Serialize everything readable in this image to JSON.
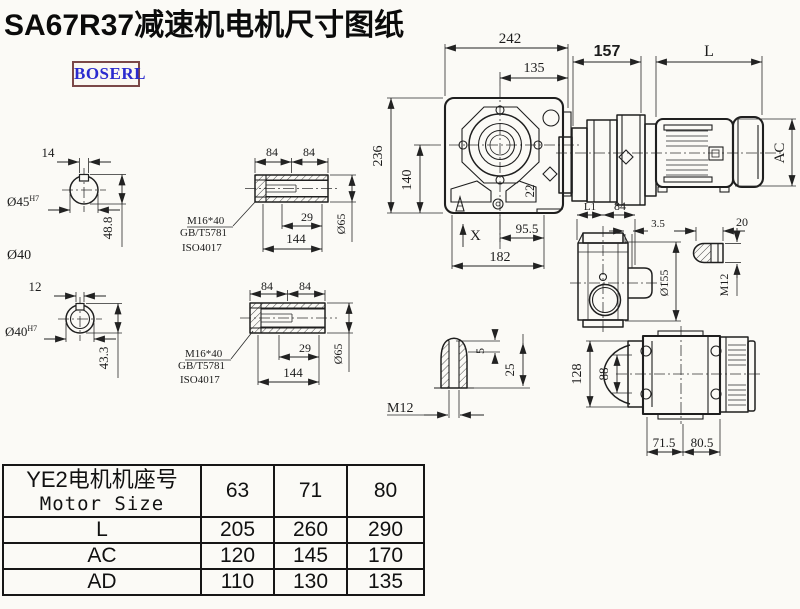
{
  "title": "SA67R37减速机电机尺寸图纸",
  "logo": "BOSERL",
  "colors": {
    "line": "#1f1f1f",
    "logo_text": "#2b2bcf",
    "logo_border": "#7b4848",
    "background": "#fbfaf6"
  },
  "views": {
    "solid_shaft_section": {
      "keyway_width": "14",
      "bore": "Ø45",
      "bore_tol": "H7",
      "keyway_height": "48.8",
      "outer_dia_label": "Ø40"
    },
    "hollow_shaft_section": {
      "keyway_width": "12",
      "bore": "Ø40",
      "bore_tol": "H7",
      "keyway_height": "43.3"
    },
    "hollow_shaft_top": {
      "seg1": "84",
      "seg2": "84",
      "bolt": "M16*40",
      "std1": "GB/T5781",
      "std2": "ISO4017",
      "key_len": "29",
      "total_len": "144",
      "dia": "Ø65"
    },
    "hollow_shaft_bottom": {
      "seg1": "84",
      "seg2": "84",
      "bolt": "M16*40",
      "std1": "GB/T5781",
      "std2": "ISO4017",
      "key_len": "29",
      "total_len": "144",
      "dia": "Ø65"
    },
    "front_view": {
      "width": "242",
      "center_to_face": "135",
      "height": "236",
      "center_height": "140",
      "bolt_size": "22",
      "foot_half": "95.5",
      "foot_width": "182",
      "marker": "X"
    },
    "side_view": {
      "gear_len": "157",
      "motor_len": "L",
      "motor_dia": "AC"
    },
    "output_side_view": {
      "len1": "L1",
      "len2": "84",
      "offset": "3.5",
      "flange_dia": "Ø155"
    },
    "key_section": {
      "width": "20",
      "thread": "M12"
    },
    "shaft_end": {
      "depth": "5",
      "length": "25",
      "thread": "M12"
    },
    "bottom_view": {
      "height": "128",
      "inner_height": "88",
      "len1": "71.5",
      "len2": "80.5"
    }
  },
  "table": {
    "header_line1": "YE2电机机座号",
    "header_line2": "Motor Size",
    "sizes": [
      "63",
      "71",
      "80"
    ],
    "rows": [
      {
        "label": "L",
        "values": [
          "205",
          "260",
          "290"
        ]
      },
      {
        "label": "AC",
        "values": [
          "120",
          "145",
          "170"
        ]
      },
      {
        "label": "AD",
        "values": [
          "110",
          "130",
          "135"
        ]
      }
    ]
  }
}
